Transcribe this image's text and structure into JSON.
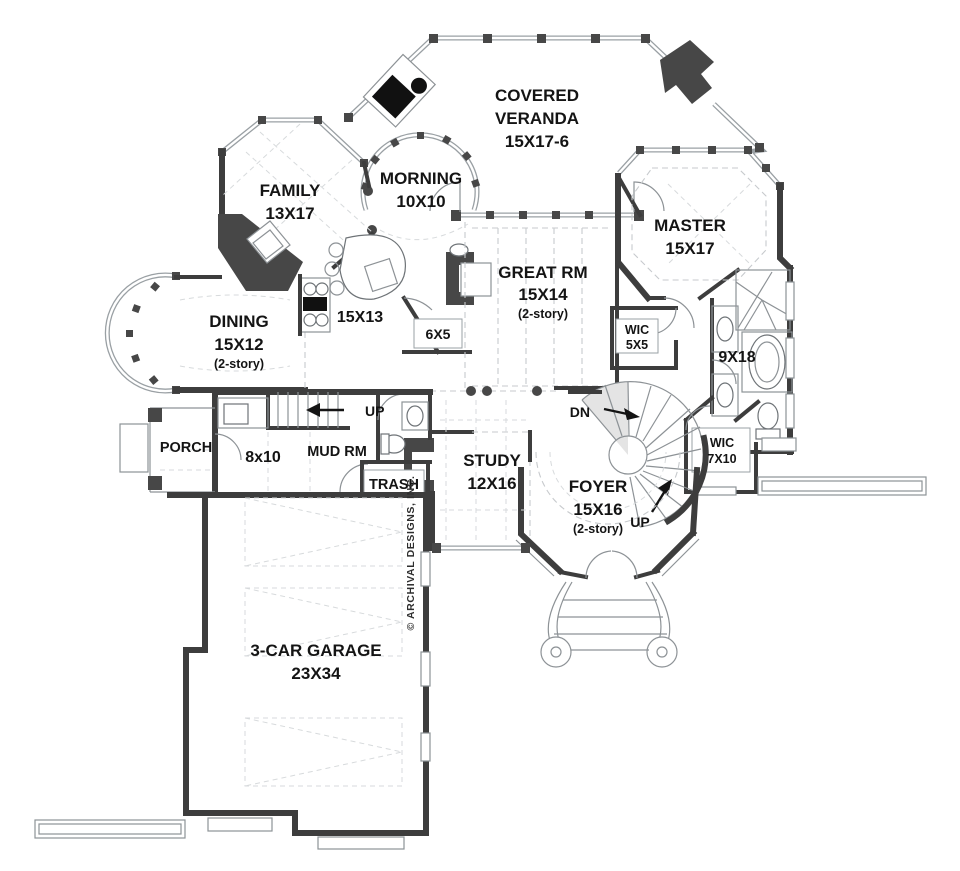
{
  "copyright": "© ARCHIVAL DESIGNS, INC.",
  "rooms": {
    "veranda": {
      "l1": "COVERED",
      "l2": "VERANDA",
      "l3": "15X17-6"
    },
    "family": {
      "l1": "FAMILY",
      "l2": "13X17"
    },
    "morning": {
      "l1": "MORNING",
      "l2": "10X10"
    },
    "master": {
      "l1": "MASTER",
      "l2": "15X17"
    },
    "great": {
      "l1": "GREAT RM",
      "l2": "15X14",
      "l3": "(2-story)"
    },
    "dining": {
      "l1": "DINING",
      "l2": "15X12",
      "l3": "(2-story)"
    },
    "kitchen": {
      "l1": "15X13"
    },
    "pantry": {
      "l1": "6X5"
    },
    "wic_master": {
      "l1": "WIC",
      "l2": "5X5"
    },
    "bath": {
      "l1": "9X18"
    },
    "foyer": {
      "l1": "FOYER",
      "l2": "15X16",
      "l3": "(2-story)"
    },
    "study": {
      "l1": "STUDY",
      "l2": "12X16"
    },
    "porch": {
      "l1": "PORCH"
    },
    "laundry": {
      "l1": "8x10"
    },
    "mud": {
      "l1": "MUD RM"
    },
    "trash": {
      "l1": "TRASH"
    },
    "wic_foyer": {
      "l1": "WIC",
      "l2": "7X10"
    },
    "garage": {
      "l1": "3-CAR GARAGE",
      "l2": "23X34"
    }
  },
  "stairs": {
    "down_label": "DN",
    "up_foyer_label": "UP",
    "up_mud_label": "UP"
  },
  "colors": {
    "wall": "#3d3d3d",
    "window_line": "#9aa0a4",
    "dashed": "#c7cacd",
    "text": "#141414",
    "stair_shade": "#e4e4e4"
  }
}
